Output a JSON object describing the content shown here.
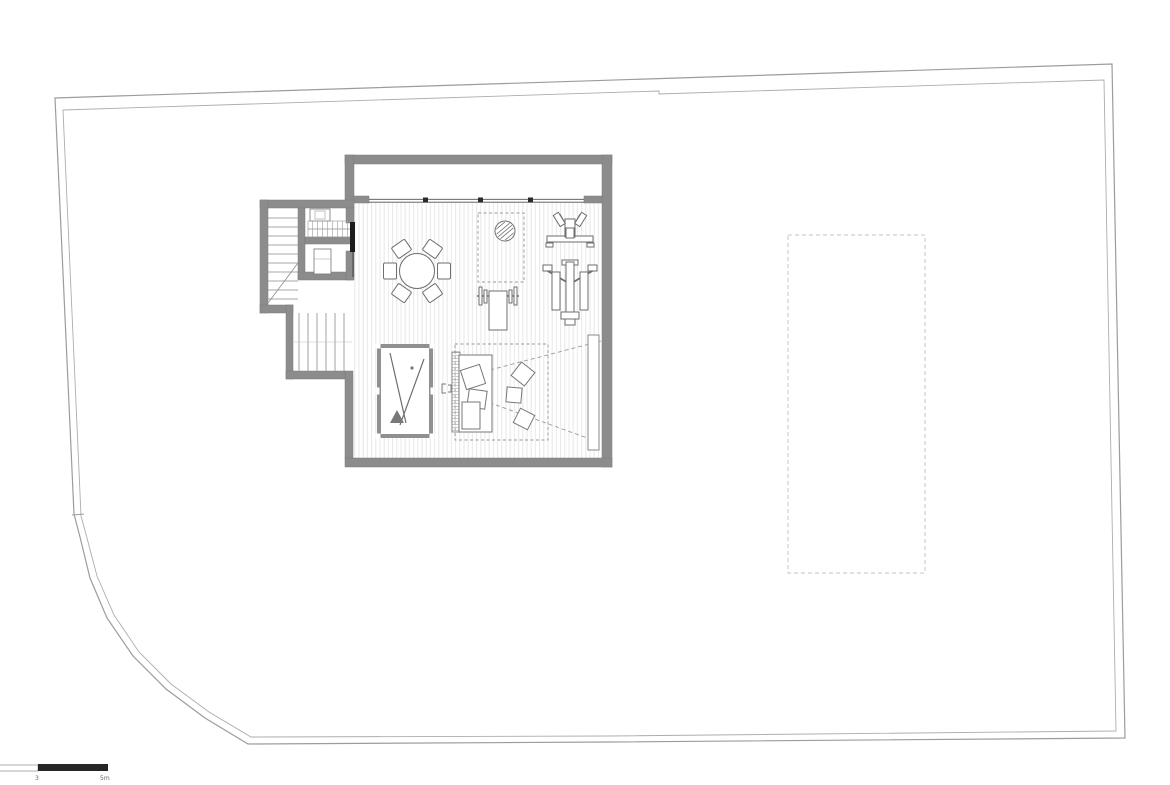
{
  "meta": {
    "drawing_type": "floor-plan"
  },
  "colors": {
    "background": "#ffffff",
    "wall": "#8c8c8c",
    "wall_edge": "#7a7a7a",
    "boundary": "#9c9c9c",
    "boundary_inner": "#ababab",
    "furniture_line": "#6e6e6e",
    "floor_hatch": "#e7e7e7",
    "dashed_outline": "#b3b3b3",
    "door_leaf": "#1c1c1c",
    "rack_triangle": "#787878",
    "scale_black": "#262626"
  },
  "scale_bar": {
    "labels": [
      "3",
      "5m"
    ]
  },
  "icons": [
    "property-boundary",
    "window-well",
    "window-band",
    "staircase",
    "sauna-room",
    "stove",
    "wc-fixture",
    "door-leaf",
    "dining-table-with-chairs",
    "exercise-mat",
    "exercise-ball",
    "bench-press",
    "shoulder-press-machine",
    "multi-gym-machine",
    "billiard-table",
    "cue-sticks",
    "rack-triangle",
    "home-cinema-area",
    "sofa",
    "bean-bags",
    "speaker",
    "projection-cone",
    "projector-screen",
    "pool-outline-above",
    "scale-bar"
  ]
}
